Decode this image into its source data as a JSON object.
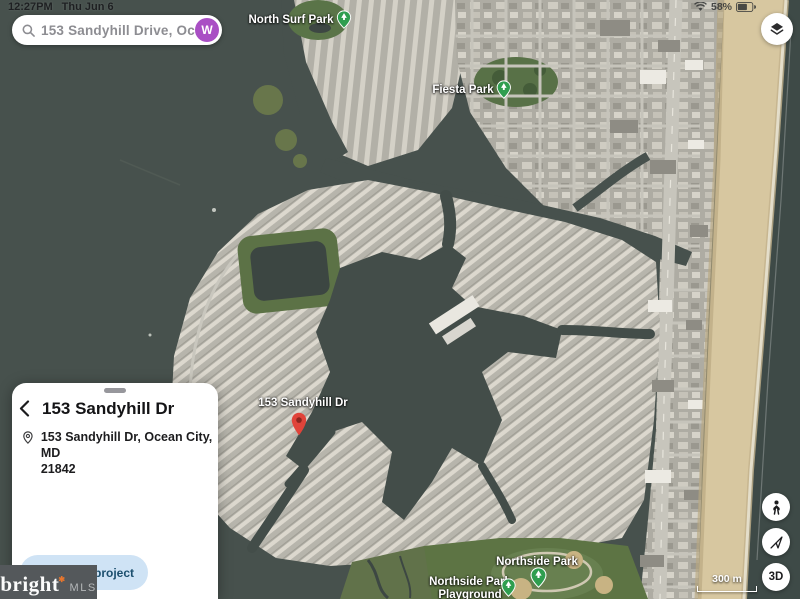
{
  "status_bar": {
    "time": "12:27PM",
    "date": "Thu Jun 6",
    "battery_percent": "58%"
  },
  "search": {
    "query": "153 Sandyhill Drive, Ocean",
    "avatar_initial": "W"
  },
  "map_labels": {
    "north_surf_park": "North Surf Park",
    "fiesta_park": "Fiesta Park",
    "destination_pin": "153 Sandyhill Dr",
    "northside_park": "Northside Park",
    "northside_playground_line1": "Northside Park",
    "northside_playground_line2": "Playground"
  },
  "map_controls": {
    "scale_label": "300 m",
    "threed_button": "3D"
  },
  "place_card": {
    "title": "153 Sandyhill Dr",
    "address_line1": "153 Sandyhill Dr, Ocean City, MD",
    "address_line2": "21842",
    "save_button_label": "Save to project"
  },
  "watermark": {
    "brand": "bright",
    "suffix": "MLS"
  },
  "colors": {
    "accent_purple": "#a94fc4",
    "pin_red": "#e0443a",
    "park_green": "#2f9e4f",
    "save_button_bg": "#cfe3f5",
    "save_button_text": "#1c4f6e",
    "watermark_bg": "#54585b",
    "watermark_orange": "#e8762d"
  }
}
